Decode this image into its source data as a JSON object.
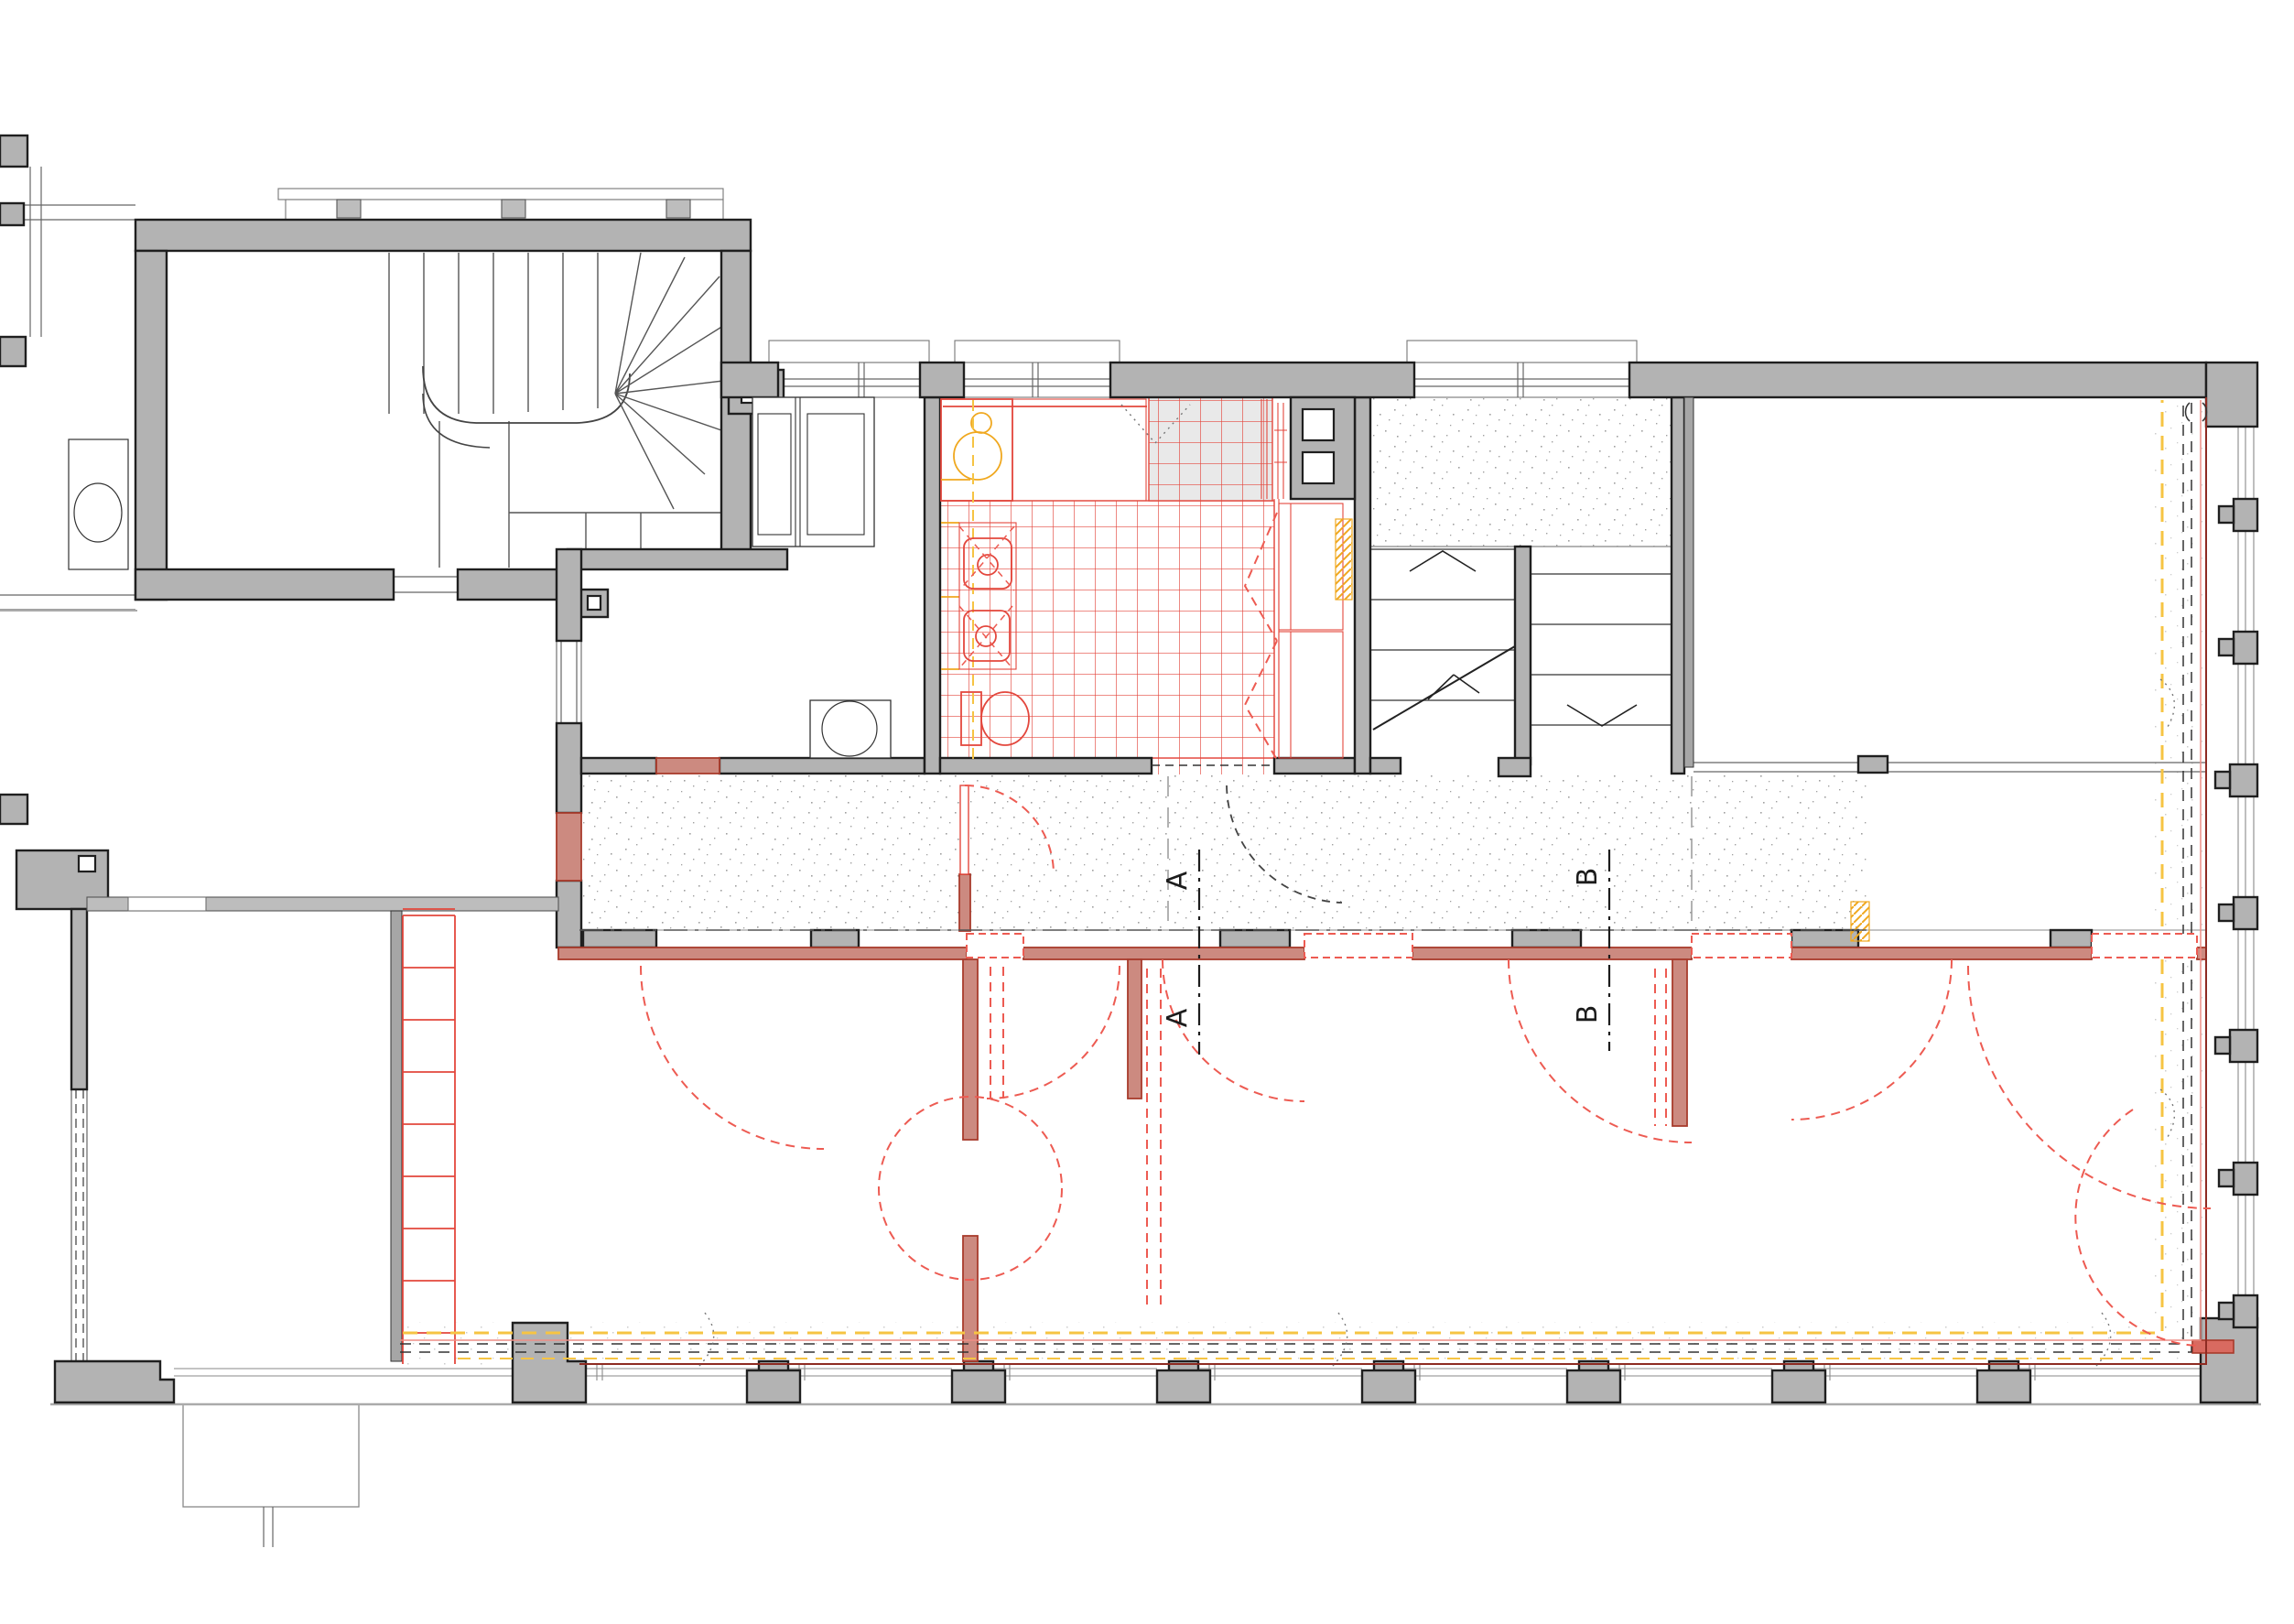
{
  "drawing": {
    "kind": "architectural floor plan",
    "section_marks": {
      "a_top": "A",
      "a_bottom": "A",
      "b_top": "B",
      "b_bottom": "B"
    }
  },
  "colors": {
    "existing_wall": "#b3b3b3",
    "outline": "#1f1f1f",
    "new_fill": "#cc8a80",
    "new_line": "#a83b2c",
    "accent_red": "#e3473d",
    "door_swing": "#ed5b52",
    "accent_yellow": "#f0a81f",
    "dashed_yellow": "#f6c443",
    "stipple": "#8f8f8f",
    "section": "#1c1c1c"
  }
}
